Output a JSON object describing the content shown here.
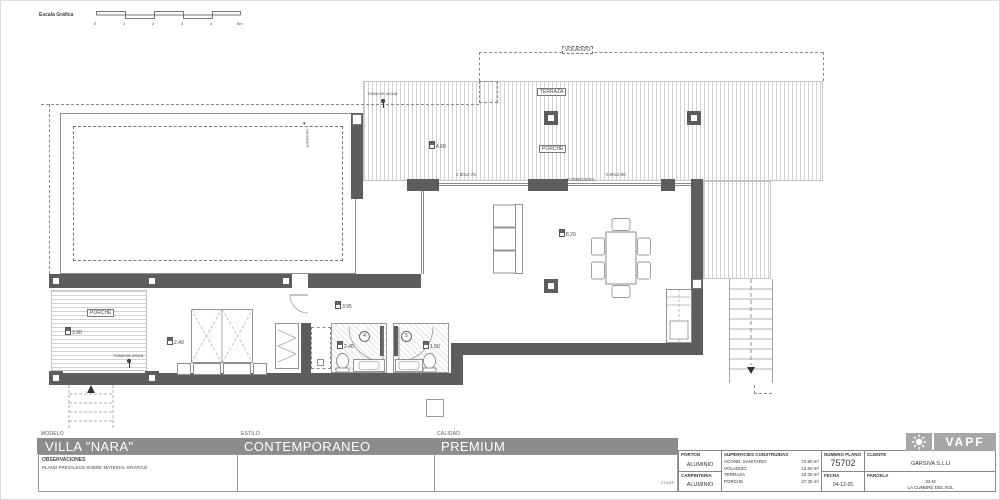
{
  "scale_bar": {
    "label": "Escala Gráfica",
    "ticks": [
      "0",
      "1",
      "2",
      "3",
      "4",
      "5m"
    ]
  },
  "plan": {
    "labels": {
      "voladizo": "VOLADIZO",
      "terraza": "TERRAZA",
      "porche_top": "PORCHE",
      "porche_left": "PORCHE",
      "toma_agua_top": "TOMA DE AGUA",
      "toma_agua_left": "TOMA DE AGUA",
      "corredera": "CORREDERA",
      "pool_fitting": "SKIMMER"
    },
    "dimensions": {
      "door_left": "2.80x2.75",
      "door_right": "0.90x2.90",
      "terrace_level": "4.60",
      "living_level": "8.20",
      "hall_level": "3.95",
      "bedroom_width": "2.40",
      "bath_a_width": "2.40",
      "bath_b_width": "1.50",
      "porch_level": "3.90"
    },
    "room_tags": {
      "bath_a": "4",
      "bath_b": "5"
    }
  },
  "title_block": {
    "modelo_label": "MODELO",
    "modelo_value": "VILLA \"NARA\"",
    "estilo_label": "ESTILO",
    "estilo_value": "CONTEMPORANEO",
    "calidad_label": "CALIDAD",
    "calidad_value": "PREMIUM",
    "observaciones_label": "OBSERVACIONES",
    "observaciones_value": "PLANO PREVALECE SOBRE MATERIAL GRÁFICO",
    "porton_label": "PORTON",
    "porton_value": "ALUMINIO",
    "carpinteria_label": "CARPINTERIA",
    "carpinteria_value": "ALUMINIO",
    "superficies_label": "SUPERFICIES CONSTRUIDAS",
    "superficies": [
      {
        "name": "ACOND. SANITARIO",
        "value": "72.80 m²"
      },
      {
        "name": "VOLADIZO",
        "value": "12.60 m²"
      },
      {
        "name": "TERRAZA",
        "value": "10.30 m²"
      },
      {
        "name": "PORCHE",
        "value": "27.30 m²"
      }
    ],
    "numero_plano_label": "NUMERO PLANO",
    "numero_plano_value": "75702",
    "fecha_label": "FECHA",
    "fecha_value": "04-12-25",
    "cliente_label": "CLIENTE",
    "cliente_value": "GARSIVA S.L.U",
    "parcela_label": "PARCELA",
    "parcela_value_line1": "33-M",
    "parcela_value_line2": "LA CUMBRE DEL SOL",
    "ref_code": "274-EP",
    "logo_text": "VAPF"
  }
}
